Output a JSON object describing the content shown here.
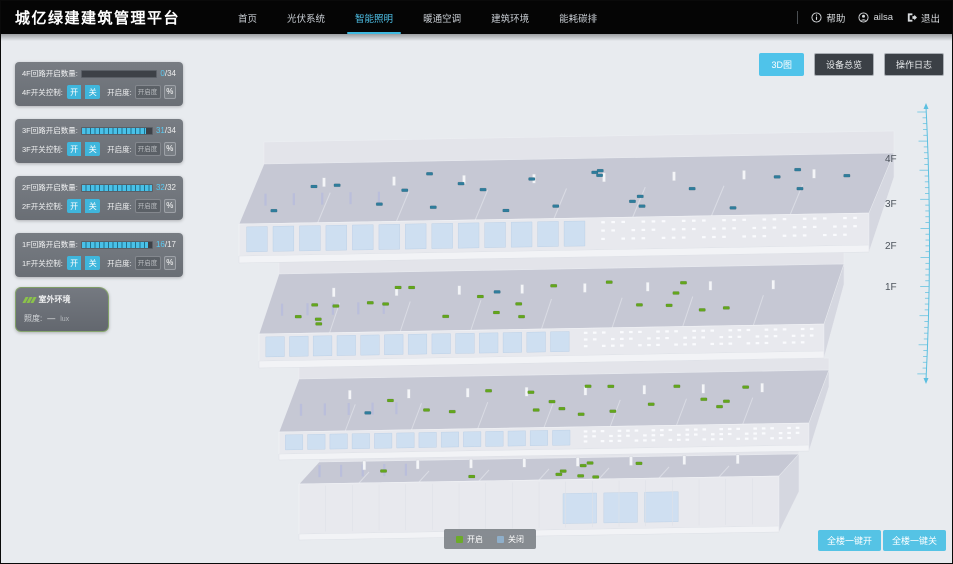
{
  "header": {
    "title": "城亿绿建建筑管理平台",
    "nav": [
      {
        "label": "首页",
        "active": false
      },
      {
        "label": "光伏系统",
        "active": false
      },
      {
        "label": "智能照明",
        "active": true
      },
      {
        "label": "暖通空调",
        "active": false
      },
      {
        "label": "建筑环境",
        "active": false
      },
      {
        "label": "能耗碳排",
        "active": false
      }
    ],
    "help_label": "帮助",
    "username": "ailsa",
    "logout_label": "退出"
  },
  "view_toolbar": {
    "buttons": [
      {
        "label": "3D图",
        "active": true
      },
      {
        "label": "设备总览",
        "active": false
      },
      {
        "label": "操作日志",
        "active": false
      }
    ]
  },
  "floor_panels": [
    {
      "circuit_label": "4F回路开启数量:",
      "on": 0,
      "total": 34,
      "count": "0",
      "total_text": "/34",
      "switch_label": "4F开关控制:",
      "on_button": "开",
      "off_button": "关",
      "dim_label": "开启度:",
      "dim_placeholder": "开启度",
      "percent_label": "%"
    },
    {
      "circuit_label": "3F回路开启数量:",
      "on": 31,
      "total": 34,
      "count": "31",
      "total_text": "/34",
      "switch_label": "3F开关控制:",
      "on_button": "开",
      "off_button": "关",
      "dim_label": "开启度:",
      "dim_placeholder": "开启度",
      "percent_label": "%"
    },
    {
      "circuit_label": "2F回路开启数量:",
      "on": 32,
      "total": 32,
      "count": "32",
      "total_text": "/32",
      "switch_label": "2F开关控制:",
      "on_button": "开",
      "off_button": "关",
      "dim_label": "开启度:",
      "dim_placeholder": "开启度",
      "percent_label": "%"
    },
    {
      "circuit_label": "1F回路开启数量:",
      "on": 16,
      "total": 17,
      "count": "16",
      "total_text": "/17",
      "switch_label": "1F开关控制:",
      "on_button": "开",
      "off_button": "关",
      "dim_label": "开启度:",
      "dim_placeholder": "开启度",
      "percent_label": "%"
    }
  ],
  "outdoor_panel": {
    "title": "室外环境",
    "metric_label": "照度:",
    "metric_value": "—",
    "metric_unit": "lux"
  },
  "floor_scale_labels": [
    "4F",
    "3F",
    "2F",
    "1F"
  ],
  "legend": {
    "on_label": "开启",
    "off_label": "关闭",
    "on_color": "#6cab29",
    "off_color": "#8fafca"
  },
  "bulk_actions": {
    "all_on_label": "全楼一键开",
    "all_off_label": "全楼一键关"
  },
  "building": {
    "floors": [
      {
        "name": "4F",
        "markers_on": 0,
        "markers_off": 24
      },
      {
        "name": "3F",
        "markers_on": 22,
        "markers_off": 1
      },
      {
        "name": "2F",
        "markers_on": 18,
        "markers_off": 1
      },
      {
        "name": "1F",
        "markers_on": 9,
        "markers_off": 0
      }
    ],
    "marker_on_color": "#63a61d",
    "marker_off_color": "#2f7d9c"
  },
  "colors": {
    "accent": "#4fc3ea",
    "header_bg": "#050505",
    "canvas_bg": "#e8ebef"
  }
}
